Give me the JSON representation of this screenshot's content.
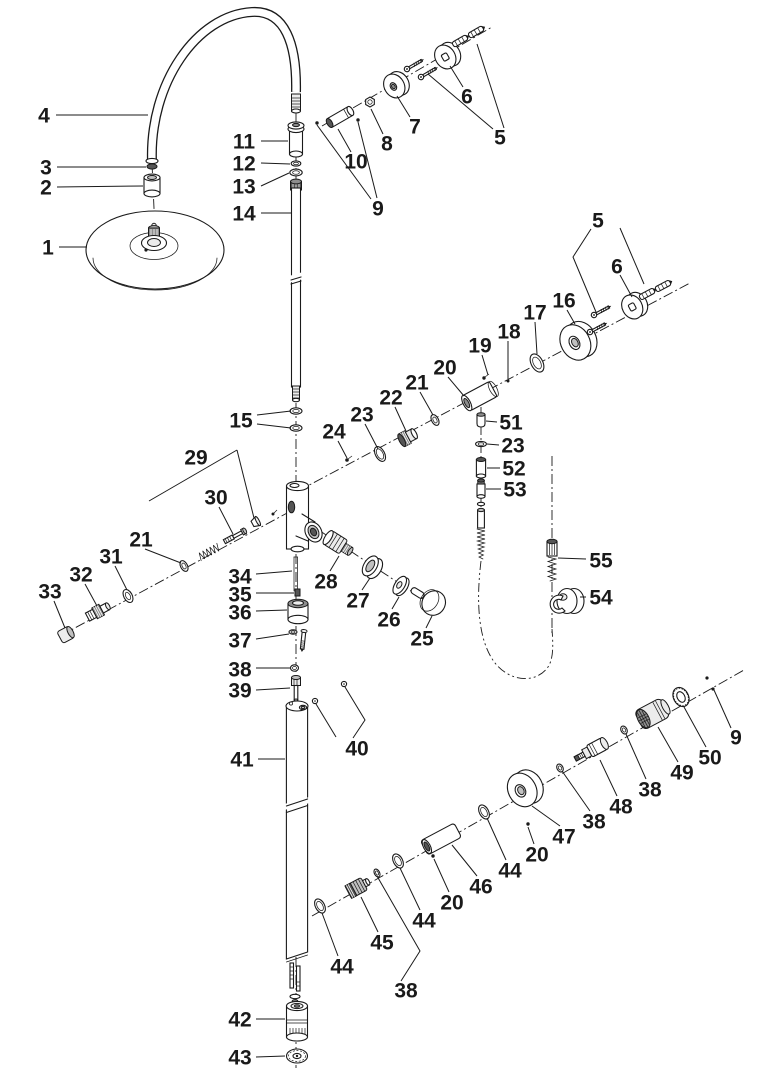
{
  "figure": {
    "type": "exploded-parts-diagram",
    "title": "Shower column exploded parts diagram",
    "colors": {
      "ink": "#1a1a1a",
      "background": "#ffffff"
    },
    "labels": [
      {
        "text": "4",
        "x": 44,
        "y": 115,
        "leaders": [
          [
            [
              56,
              115
            ],
            [
              148,
              115
            ]
          ]
        ]
      },
      {
        "text": "3",
        "x": 46,
        "y": 167,
        "leaders": [
          [
            [
              57,
              167
            ],
            [
              146,
              167
            ]
          ]
        ]
      },
      {
        "text": "2",
        "x": 46,
        "y": 187,
        "leaders": [
          [
            [
              57,
              187
            ],
            [
              143,
              186
            ]
          ]
        ]
      },
      {
        "text": "1",
        "x": 48,
        "y": 247,
        "leaders": [
          [
            [
              59,
              247
            ],
            [
              87,
              247
            ]
          ]
        ]
      },
      {
        "text": "11",
        "x": 244,
        "y": 141,
        "leaders": [
          [
            [
              261,
              141
            ],
            [
              288,
              141
            ]
          ]
        ]
      },
      {
        "text": "12",
        "x": 244,
        "y": 163,
        "leaders": [
          [
            [
              261,
              163
            ],
            [
              290,
              164
            ]
          ]
        ]
      },
      {
        "text": "13",
        "x": 244,
        "y": 186,
        "leaders": [
          [
            [
              261,
              186
            ],
            [
              289,
              173
            ]
          ]
        ]
      },
      {
        "text": "14",
        "x": 244,
        "y": 213,
        "leaders": [
          [
            [
              261,
              213
            ],
            [
              291,
              213
            ]
          ]
        ]
      },
      {
        "text": "10",
        "x": 356,
        "y": 161,
        "leaders": [
          [
            [
              351,
              152
            ],
            [
              338,
              129
            ]
          ]
        ]
      },
      {
        "text": "8",
        "x": 387,
        "y": 143,
        "leaders": [
          [
            [
              383,
              134
            ],
            [
              371,
              109
            ]
          ]
        ]
      },
      {
        "text": "7",
        "x": 415,
        "y": 126,
        "leaders": [
          [
            [
              410,
              117
            ],
            [
              397,
              96
            ]
          ]
        ]
      },
      {
        "text": "9",
        "x": 378,
        "y": 208,
        "leaders": [
          [
            [
              371,
              199
            ],
            [
              317,
              125
            ]
          ],
          [
            [
              377,
              198
            ],
            [
              358,
              122
            ]
          ]
        ]
      },
      {
        "text": "6",
        "x": 467,
        "y": 96,
        "leaders": [
          [
            [
              463,
              87
            ],
            [
              450,
              66
            ]
          ]
        ]
      },
      {
        "text": "5",
        "x": 500,
        "y": 137,
        "leaders": [
          [
            [
              493,
              129
            ],
            [
              428,
              74
            ]
          ],
          [
            [
              504,
              128
            ],
            [
              477,
              44
            ]
          ]
        ]
      },
      {
        "text": "5",
        "x": 598,
        "y": 220,
        "leaders": [
          [
            [
              591,
              229
            ],
            [
              573,
              257
            ],
            [
              596,
              312
            ]
          ],
          [
            [
              620,
              228
            ],
            [
              644,
              284
            ]
          ]
        ]
      },
      {
        "text": "6",
        "x": 617,
        "y": 266,
        "leaders": [
          [
            [
              620,
              275
            ],
            [
              632,
              297
            ]
          ]
        ]
      },
      {
        "text": "16",
        "x": 564,
        "y": 300,
        "leaders": [
          [
            [
              567,
              310
            ],
            [
              575,
              324
            ]
          ]
        ]
      },
      {
        "text": "17",
        "x": 535,
        "y": 312,
        "leaders": [
          [
            [
              535,
              322
            ],
            [
              537,
              354
            ]
          ]
        ]
      },
      {
        "text": "18",
        "x": 509,
        "y": 331,
        "leaders": [
          [
            [
              508,
              341
            ],
            [
              508,
              379
            ]
          ]
        ]
      },
      {
        "text": "19",
        "x": 480,
        "y": 345,
        "leaders": [
          [
            [
              482,
              355
            ],
            [
              488,
              375
            ]
          ]
        ]
      },
      {
        "text": "20",
        "x": 445,
        "y": 367,
        "leaders": [
          [
            [
              448,
              377
            ],
            [
              464,
              396
            ]
          ]
        ]
      },
      {
        "text": "21",
        "x": 417,
        "y": 382,
        "leaders": [
          [
            [
              420,
              392
            ],
            [
              433,
              415
            ]
          ]
        ]
      },
      {
        "text": "22",
        "x": 391,
        "y": 397,
        "leaders": [
          [
            [
              395,
              407
            ],
            [
              406,
              431
            ]
          ]
        ]
      },
      {
        "text": "23",
        "x": 362,
        "y": 414,
        "leaders": [
          [
            [
              365,
              424
            ],
            [
              378,
              449
            ]
          ]
        ]
      },
      {
        "text": "24",
        "x": 334,
        "y": 431,
        "leaders": [
          [
            [
              338,
              441
            ],
            [
              347,
              458
            ]
          ]
        ]
      },
      {
        "text": "15",
        "x": 241,
        "y": 420,
        "leaders": [
          [
            [
              257,
              415
            ],
            [
              291,
              411
            ]
          ],
          [
            [
              257,
              424
            ],
            [
              291,
              428
            ]
          ]
        ]
      },
      {
        "text": "51",
        "x": 511,
        "y": 422,
        "leaders": [
          [
            [
              497,
              422
            ],
            [
              486,
              421
            ]
          ]
        ]
      },
      {
        "text": "23",
        "x": 513,
        "y": 445,
        "leaders": [
          [
            [
              499,
              445
            ],
            [
              487,
              444
            ]
          ]
        ]
      },
      {
        "text": "52",
        "x": 514,
        "y": 468,
        "leaders": [
          [
            [
              500,
              468
            ],
            [
              487,
              468
            ]
          ]
        ]
      },
      {
        "text": "53",
        "x": 515,
        "y": 489,
        "leaders": [
          [
            [
              501,
              489
            ],
            [
              486,
              489
            ]
          ]
        ]
      },
      {
        "text": "55",
        "x": 601,
        "y": 560,
        "leaders": [
          [
            [
              586,
              559
            ],
            [
              558,
              558
            ]
          ]
        ]
      },
      {
        "text": "54",
        "x": 601,
        "y": 597,
        "leaders": [
          [
            [
              586,
              597
            ],
            [
              580,
              597
            ]
          ]
        ]
      },
      {
        "text": "29",
        "x": 196,
        "y": 457,
        "leaders": [
          [
            [
              237,
              450
            ],
            [
              149,
              501
            ]
          ],
          [
            [
              237,
              450
            ],
            [
              254,
              518
            ]
          ]
        ]
      },
      {
        "text": "30",
        "x": 216,
        "y": 497,
        "leaders": [
          [
            [
              219,
              507
            ],
            [
              233,
              534
            ]
          ]
        ]
      },
      {
        "text": "21",
        "x": 141,
        "y": 539,
        "leaders": [
          [
            [
              145,
              549
            ],
            [
              181,
              563
            ]
          ]
        ]
      },
      {
        "text": "31",
        "x": 111,
        "y": 556,
        "leaders": [
          [
            [
              115,
              566
            ],
            [
              127,
              590
            ]
          ]
        ]
      },
      {
        "text": "32",
        "x": 81,
        "y": 574,
        "leaders": [
          [
            [
              85,
              584
            ],
            [
              97,
              606
            ]
          ]
        ]
      },
      {
        "text": "33",
        "x": 50,
        "y": 591,
        "leaders": [
          [
            [
              54,
              601
            ],
            [
              65,
              628
            ]
          ]
        ]
      },
      {
        "text": "28",
        "x": 326,
        "y": 581,
        "leaders": [
          [
            [
              330,
              571
            ],
            [
              339,
              556
            ]
          ]
        ]
      },
      {
        "text": "27",
        "x": 358,
        "y": 600,
        "leaders": [
          [
            [
              362,
              590
            ],
            [
              370,
              578
            ]
          ]
        ]
      },
      {
        "text": "26",
        "x": 389,
        "y": 619,
        "leaders": [
          [
            [
              392,
              609
            ],
            [
              399,
              597
            ]
          ]
        ]
      },
      {
        "text": "25",
        "x": 422,
        "y": 638,
        "leaders": [
          [
            [
              426,
              628
            ],
            [
              432,
              616
            ]
          ]
        ]
      },
      {
        "text": "34",
        "x": 240,
        "y": 576,
        "leaders": [
          [
            [
              256,
              574
            ],
            [
              292,
              571
            ]
          ]
        ]
      },
      {
        "text": "35",
        "x": 240,
        "y": 594,
        "leaders": [
          [
            [
              256,
              593
            ],
            [
              294,
              593
            ]
          ]
        ]
      },
      {
        "text": "36",
        "x": 240,
        "y": 612,
        "leaders": [
          [
            [
              256,
              611
            ],
            [
              287,
              610
            ]
          ]
        ]
      },
      {
        "text": "37",
        "x": 240,
        "y": 640,
        "leaders": [
          [
            [
              256,
              639
            ],
            [
              289,
              634
            ]
          ]
        ]
      },
      {
        "text": "38",
        "x": 240,
        "y": 669,
        "leaders": [
          [
            [
              256,
              668
            ],
            [
              290,
              668
            ]
          ]
        ]
      },
      {
        "text": "39",
        "x": 240,
        "y": 690,
        "leaders": [
          [
            [
              256,
              690
            ],
            [
              290,
              688
            ]
          ]
        ]
      },
      {
        "text": "40",
        "x": 357,
        "y": 748,
        "leaders": [
          [
            [
              345,
              687
            ],
            [
              365,
              720
            ],
            [
              353,
              738
            ]
          ],
          [
            [
              316,
              704
            ],
            [
              336,
              737
            ]
          ]
        ]
      },
      {
        "text": "41",
        "x": 242,
        "y": 759,
        "leaders": [
          [
            [
              258,
              759
            ],
            [
              285,
              759
            ]
          ]
        ]
      },
      {
        "text": "42",
        "x": 240,
        "y": 1019,
        "leaders": [
          [
            [
              256,
              1019
            ],
            [
              285,
              1019
            ]
          ]
        ]
      },
      {
        "text": "43",
        "x": 240,
        "y": 1057,
        "leaders": [
          [
            [
              256,
              1057
            ],
            [
              285,
              1056
            ]
          ]
        ]
      },
      {
        "text": "9",
        "x": 736,
        "y": 737,
        "leaders": [
          [
            [
              731,
              728
            ],
            [
              714,
              690
            ]
          ]
        ]
      },
      {
        "text": "50",
        "x": 710,
        "y": 757,
        "leaders": [
          [
            [
              706,
              747
            ],
            [
              684,
              707
            ]
          ]
        ]
      },
      {
        "text": "49",
        "x": 682,
        "y": 772,
        "leaders": [
          [
            [
              678,
              762
            ],
            [
              658,
              727
            ]
          ]
        ]
      },
      {
        "text": "38",
        "x": 650,
        "y": 789,
        "leaders": [
          [
            [
              646,
              779
            ],
            [
              626,
              734
            ]
          ]
        ]
      },
      {
        "text": "48",
        "x": 621,
        "y": 806,
        "leaders": [
          [
            [
              617,
              796
            ],
            [
              600,
              760
            ]
          ]
        ]
      },
      {
        "text": "38",
        "x": 594,
        "y": 821,
        "leaders": [
          [
            [
              590,
              811
            ],
            [
              562,
              771
            ]
          ]
        ]
      },
      {
        "text": "47",
        "x": 564,
        "y": 836,
        "leaders": [
          [
            [
              560,
              826
            ],
            [
              532,
              806
            ]
          ]
        ]
      },
      {
        "text": "20",
        "x": 537,
        "y": 854,
        "leaders": [
          [
            [
              534,
              844
            ],
            [
              528,
              827
            ]
          ]
        ]
      },
      {
        "text": "44",
        "x": 510,
        "y": 870,
        "leaders": [
          [
            [
              506,
              860
            ],
            [
              487,
              818
            ]
          ]
        ]
      },
      {
        "text": "46",
        "x": 481,
        "y": 886,
        "leaders": [
          [
            [
              477,
              876
            ],
            [
              452,
              845
            ]
          ]
        ]
      },
      {
        "text": "20",
        "x": 452,
        "y": 902,
        "leaders": [
          [
            [
              449,
              892
            ],
            [
              434,
              859
            ]
          ]
        ]
      },
      {
        "text": "44",
        "x": 424,
        "y": 920,
        "leaders": [
          [
            [
              420,
              910
            ],
            [
              400,
              868
            ]
          ]
        ]
      },
      {
        "text": "45",
        "x": 382,
        "y": 942,
        "leaders": [
          [
            [
              378,
              932
            ],
            [
              361,
              897
            ]
          ]
        ]
      },
      {
        "text": "44",
        "x": 342,
        "y": 966,
        "leaders": [
          [
            [
              338,
              956
            ],
            [
              322,
              913
            ]
          ]
        ]
      },
      {
        "text": "38",
        "x": 406,
        "y": 990,
        "leaders": [
          [
            [
              401,
              981
            ],
            [
              420,
              951
            ],
            [
              377,
              876
            ]
          ]
        ]
      }
    ]
  }
}
